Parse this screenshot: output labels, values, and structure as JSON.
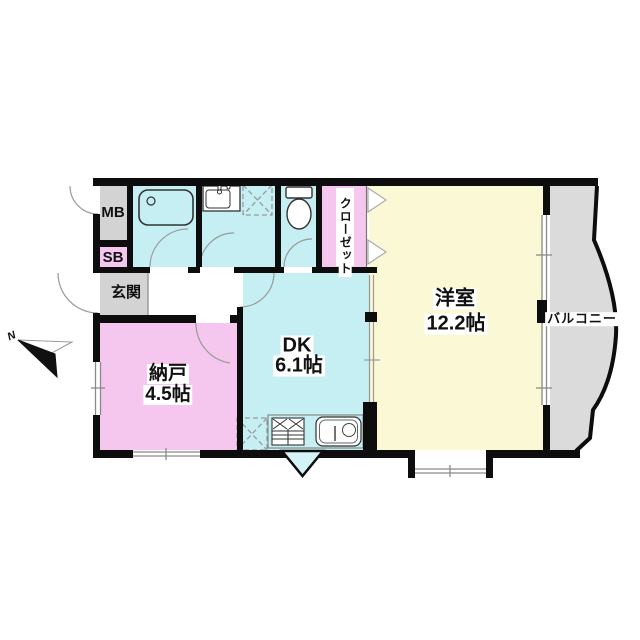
{
  "floorplan": {
    "type": "japanese-apartment-floor-plan",
    "compass": {
      "north_label": "N",
      "direction": "upper-left"
    },
    "rooms": {
      "western_room": {
        "name": "洋室",
        "size": "12.2帖",
        "fill": "#FAF8D5"
      },
      "dining_kitchen": {
        "name": "DK",
        "size": "6.1帖",
        "fill": "#C5EFF2"
      },
      "storage_room": {
        "name": "納戸",
        "size": "4.5帖",
        "fill": "#F5C6EE"
      },
      "entrance": {
        "name": "玄関",
        "fill": "#D3D3D3"
      },
      "meter_box": {
        "name": "MB",
        "fill": "#D3D3D3"
      },
      "shoe_box": {
        "name": "SB",
        "fill": "#F5C6EE"
      },
      "closet": {
        "name": "クローゼット",
        "fill": "#F5C6EE"
      },
      "balcony": {
        "name": "バルコニー",
        "fill": "#DBDBDB"
      },
      "bathroom": {
        "fill": "#C5EFF2"
      },
      "washroom": {
        "fill": "#C5EFF2"
      },
      "toilet_room": {
        "fill": "#C5EFF2"
      }
    },
    "fixtures": [
      "bathtub",
      "washbasin",
      "washing-machine-space",
      "toilet",
      "gas-stove",
      "kitchen-sink",
      "refrigerator-space",
      "closet-folding-doors",
      "bay-window",
      "sliding-door",
      "entrance-door"
    ],
    "colors": {
      "wall": "#0d0d0d",
      "thin_line": "#999999",
      "fixture_outline": "#333333",
      "triangle_fill": "#D5F2F6",
      "background": "#ffffff"
    }
  }
}
